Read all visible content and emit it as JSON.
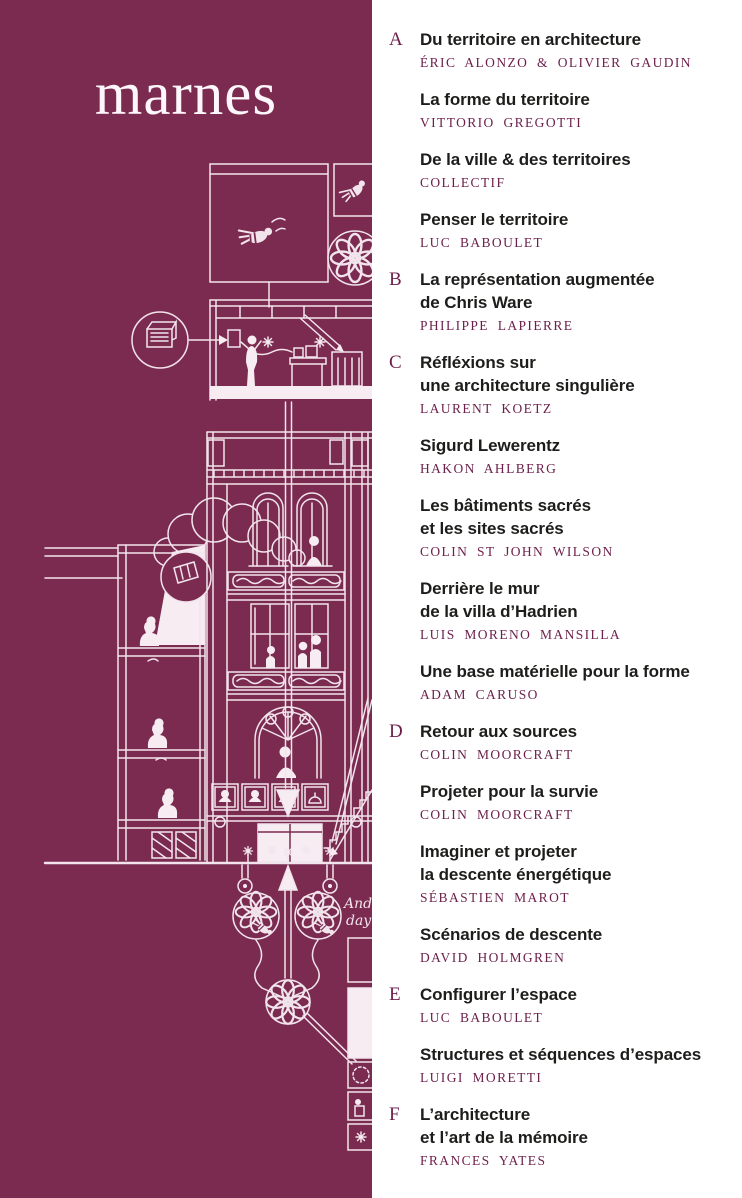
{
  "brand": {
    "logo_text": "marnes"
  },
  "colors": {
    "panel_bg": "#7b2b50",
    "accent": "#6d1f4b",
    "title_text": "#1d1d1b",
    "page_bg": "#ffffff",
    "line_art": "#f2e4ec"
  },
  "illustration": {
    "description": "White line drawing of a building cross-section with bees, flower rosettes, kneeling figures, arched windows and stairs",
    "script_line1": "And",
    "script_line2": "day"
  },
  "toc": {
    "entries": [
      {
        "section": "A",
        "title_lines": [
          "Du territoire en architecture",
          ""
        ],
        "author": "ÉRIC ALONZO & OLIVIER GAUDIN"
      },
      {
        "section": "",
        "title_lines": [
          "La forme du territoire",
          ""
        ],
        "author": "VITTORIO GREGOTTI"
      },
      {
        "section": "",
        "title_lines": [
          "De la ville & des territoires",
          ""
        ],
        "author": "COLLECTIF"
      },
      {
        "section": "",
        "title_lines": [
          "Penser le territoire",
          ""
        ],
        "author": "LUC BABOULET"
      },
      {
        "section": "B",
        "title_lines": [
          "La représentation augmentée",
          "de Chris Ware"
        ],
        "author": "PHILIPPE LAPIERRE"
      },
      {
        "section": "C",
        "title_lines": [
          "Réfléxions sur",
          "une architecture singulière"
        ],
        "author": "LAURENT KOETZ"
      },
      {
        "section": "",
        "title_lines": [
          "Sigurd Lewerentz",
          ""
        ],
        "author": "HAKON AHLBERG"
      },
      {
        "section": "",
        "title_lines": [
          "Les bâtiments sacrés",
          "et les sites sacrés"
        ],
        "author": "COLIN ST JOHN WILSON"
      },
      {
        "section": "",
        "title_lines": [
          "Derrière le mur",
          "de la villa d’Hadrien"
        ],
        "author": "LUIS MORENO MANSILLA"
      },
      {
        "section": "",
        "title_lines": [
          "Une base matérielle pour la forme",
          ""
        ],
        "author": "ADAM CARUSO"
      },
      {
        "section": "D",
        "title_lines": [
          "Retour aux sources",
          ""
        ],
        "author": "COLIN MOORCRAFT"
      },
      {
        "section": "",
        "title_lines": [
          "Projeter pour la survie",
          ""
        ],
        "author": "COLIN MOORCRAFT"
      },
      {
        "section": "",
        "title_lines": [
          "Imaginer et projeter",
          "la descente énergétique"
        ],
        "author": "SÉBASTIEN MAROT"
      },
      {
        "section": "",
        "title_lines": [
          "Scénarios de descente",
          ""
        ],
        "author": "DAVID HOLMGREN"
      },
      {
        "section": "E",
        "title_lines": [
          "Configurer l’espace",
          ""
        ],
        "author": "LUC BABOULET"
      },
      {
        "section": "",
        "title_lines": [
          "Structures et séquences d’espaces",
          ""
        ],
        "author": "LUIGI MORETTI"
      },
      {
        "section": "F",
        "title_lines": [
          "L’architecture",
          "et l’art de la mémoire"
        ],
        "author": "FRANCES YATES"
      }
    ]
  }
}
